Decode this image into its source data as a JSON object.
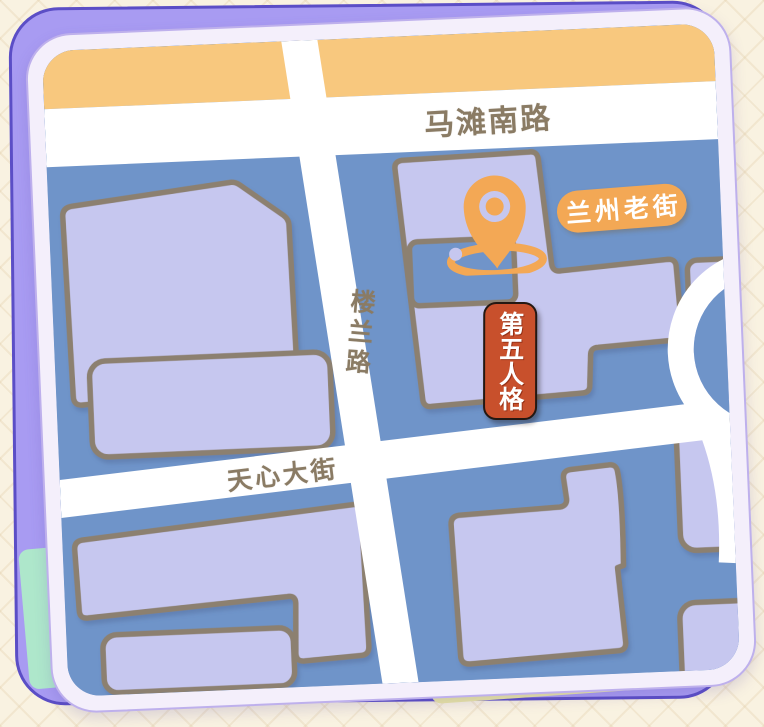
{
  "map": {
    "roads": {
      "matan": "马滩南路",
      "loulan": "楼兰路",
      "tianxin": "天心大街"
    },
    "labels": {
      "old_street": "兰州老街",
      "game": "第五人格"
    },
    "colors": {
      "map_blue": "#6f94c9",
      "building_fill": "#c6c7ef",
      "building_outline": "#8c8070",
      "road_white": "#ffffff",
      "top_band_orange": "#f8c87e",
      "pin_orange": "#f3a855",
      "badge_red": "#c8502c",
      "road_text_brown": "#8a7b64",
      "back_card_purple": "#a89bf2",
      "card_frame": "#f4effb",
      "background_cream": "#f9f2e1",
      "yellow_sliver": "#ebe8a4",
      "mint_sliver": "#aee7cb"
    }
  }
}
